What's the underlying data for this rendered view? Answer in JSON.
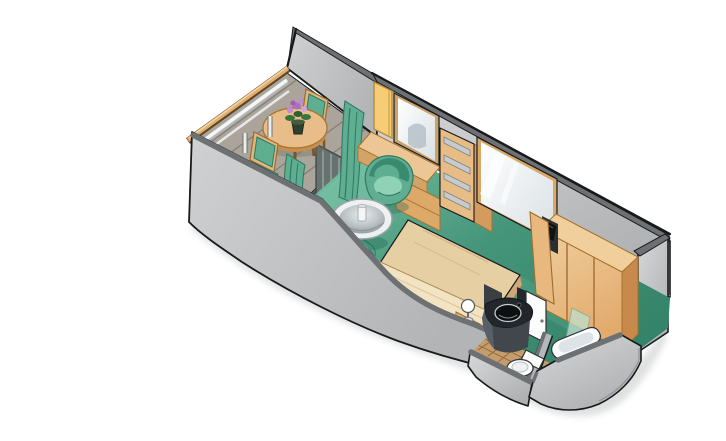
{
  "meta": {
    "label": "Isometric cutaway floor plan of a cruise ship balcony stateroom",
    "width_px": 726,
    "height_px": 409
  },
  "palette": {
    "bg": "#ffffff",
    "outline": "#17191b",
    "wall_light": "#d6d8da",
    "wall_mid": "#aeb0b2",
    "wall_top": "#6e7174",
    "carpet_light": "#7cc5a9",
    "carpet_mid": "#45957a",
    "carpet_dark": "#2e7d64",
    "wood_light": "#f0cf9d",
    "wood_mid": "#e2ab6e",
    "wood_dark": "#c8894a",
    "wood_line": "#a4732f",
    "teal_light": "#8fd2b6",
    "teal_mid": "#5fae92",
    "teal_dark": "#2f7a62",
    "bed_light": "#f2e3c2",
    "bed_mid": "#e6cfa2",
    "bed_dark": "#d3b083",
    "deck": "#aaa49a",
    "deck_line": "#7e776d",
    "counter_top": "#23272c",
    "counter_front": "#41474d",
    "sink": "#0d0f11",
    "tile": "#c59c6b",
    "tile_line": "#8a6138",
    "mirror_hi": "#ffffff",
    "mirror_lo": "#d9e0e4",
    "yellow_panel": "#f6cc74",
    "flower_purple": "#b06cc4",
    "flower_leaf": "#39743f",
    "door_glass": "#667170"
  },
  "scene": {
    "rooms": [
      {
        "name": "balcony",
        "items": [
          "railing",
          "deck-planks",
          "round-table",
          "flower-pot",
          "chair",
          "chair",
          "privacy-divider-wall"
        ]
      },
      {
        "name": "stateroom",
        "items": [
          "sliding-glass-door",
          "curtains",
          "desk-vanity",
          "vanity-mirror",
          "shelf-unit",
          "wall-mirror",
          "tub-chair",
          "glass-table",
          "bench",
          "bed",
          "nightstand-lamps",
          "wardrobe",
          "tv"
        ]
      },
      {
        "name": "bathroom",
        "items": [
          "vanity-counter",
          "sink",
          "door",
          "tiled-floor",
          "toilet",
          "bathtub",
          "shower-glass"
        ]
      }
    ]
  }
}
